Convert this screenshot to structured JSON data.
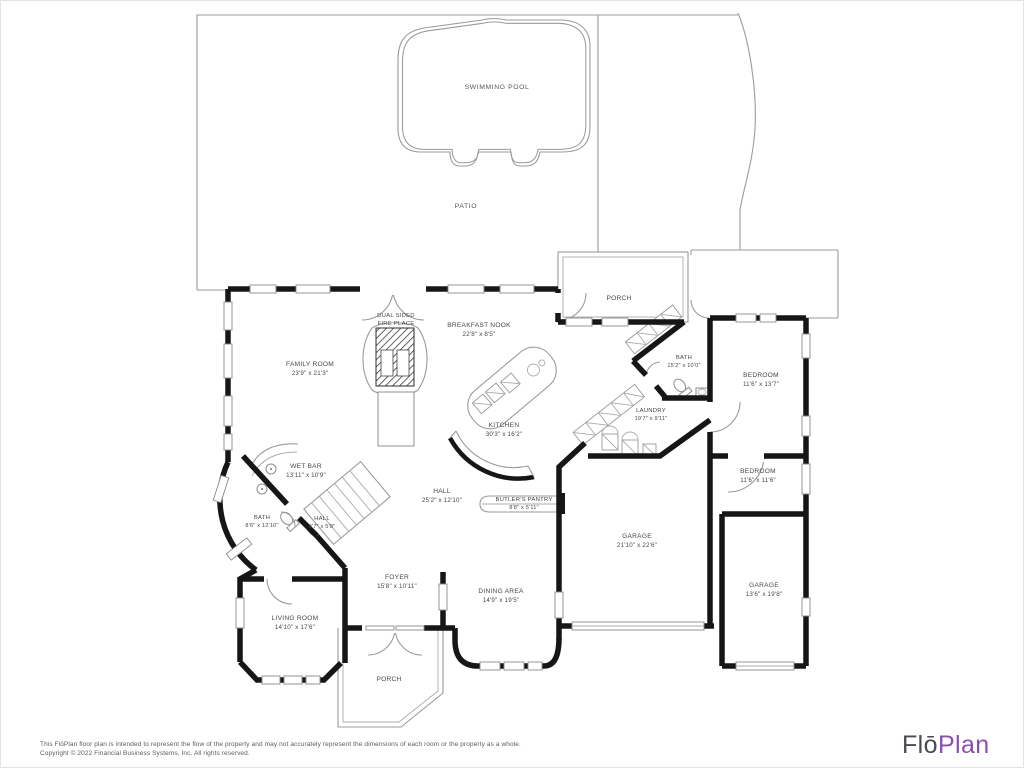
{
  "document": {
    "type": "floor-plan"
  },
  "outdoor": {
    "swimming_pool": {
      "name": "SWIMMING POOL"
    },
    "patio": {
      "name": "PATIO"
    }
  },
  "labels": {
    "porch_top": {
      "name": "PORCH"
    },
    "fireplace": {
      "line1": "DUAL SIDED",
      "line2": "FIRE PLACE"
    },
    "breakfast_nook": {
      "name": "BREAKFAST NOOK",
      "dims": "22'8\" x 8'5\""
    },
    "family_room": {
      "name": "FAMILY ROOM",
      "dims": "23'9\" x 21'3\""
    },
    "kitchen": {
      "name": "KITCHEN",
      "dims": "30'3\" x 16'2\""
    },
    "wet_bar": {
      "name": "WET BAR",
      "dims": "13'11\" x 10'9\""
    },
    "bath_small": {
      "name": "BATH",
      "dims": "8'6\" x 12'10\""
    },
    "hall_small": {
      "name": "HALL",
      "dims": "9'7\" x 5'8\""
    },
    "hall_main": {
      "name": "HALL",
      "dims": "25'2\" x 12'10\""
    },
    "butlers_pantry": {
      "name": "BUTLER'S PANTRY",
      "dims": "8'8\" x 5'11\""
    },
    "bath_right": {
      "name": "BATH",
      "dims": "15'2\" x 10'0\""
    },
    "laundry": {
      "name": "LAUNDRY",
      "dims": "19'7\" x 9'11\""
    },
    "bedroom_top": {
      "name": "BEDROOM",
      "dims": "11'6\" x 13'7\""
    },
    "bedroom_mid": {
      "name": "BEDROOM",
      "dims": "11'6\" x 11'6\""
    },
    "garage_large": {
      "name": "GARAGE",
      "dims": "21'10\" x 22'6\""
    },
    "garage_small": {
      "name": "GARAGE",
      "dims": "13'6\" x 19'8\""
    },
    "foyer": {
      "name": "FOYER",
      "dims": "15'8\" x 10'11\""
    },
    "dining_area": {
      "name": "DINING AREA",
      "dims": "14'9\" x 19'5\""
    },
    "living_room": {
      "name": "LIVING ROOM",
      "dims": "14'10\" x 17'6\""
    },
    "porch_bottom": {
      "name": "PORCH"
    }
  },
  "footer": {
    "disclaimer_line1": "This FlōPlan floor plan is intended to represent the flow of the property and may not accurately represent the dimensions of each room or the property as a whole.",
    "disclaimer_line2": "Copyright © 2022 Financial Business Systems, Inc. All rights reserved.",
    "logo_part1": "Flō",
    "logo_part2": "Plan"
  },
  "colors": {
    "wall": "#161616",
    "thin_line": "#9b9b9b",
    "label_text": "#474747",
    "logo_gray": "#4c4953",
    "logo_purple": "#8a4fb0",
    "background": "#ffffff"
  }
}
